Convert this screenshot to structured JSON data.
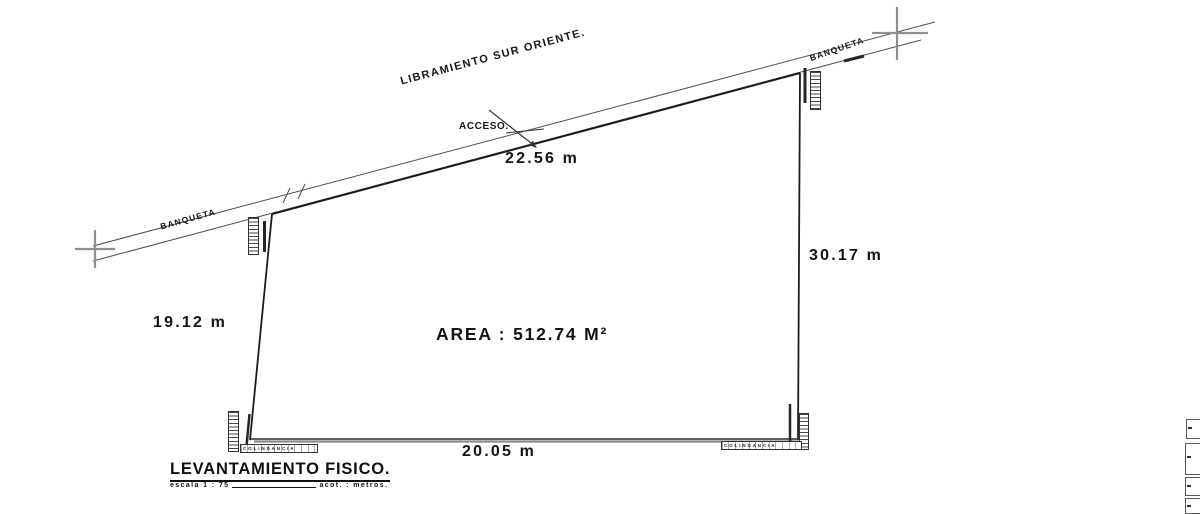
{
  "drawing": {
    "street_label": "LIBRAMIENTO SUR ORIENTE.",
    "banqueta_left": "BANQUETA",
    "banqueta_right": "BANQUETA",
    "access_label": "ACCESO.",
    "area_label": "AREA : 512.74 M²",
    "dim_top": "22.56 m",
    "dim_right": "30.17 m",
    "dim_left": "19.12 m",
    "dim_bottom": "20.05 m",
    "colindancia_bottom_left": "COLINDANCIA",
    "colindancia_bottom_right": "COLINDANCIA",
    "title": "LEVANTAMIENTO FISICO.",
    "scale_label": "escala 1 : 75",
    "units_label": "acot. : metros.",
    "colors": {
      "ink": "#1c1c1c",
      "gray_marker": "#8f8f8f"
    }
  }
}
